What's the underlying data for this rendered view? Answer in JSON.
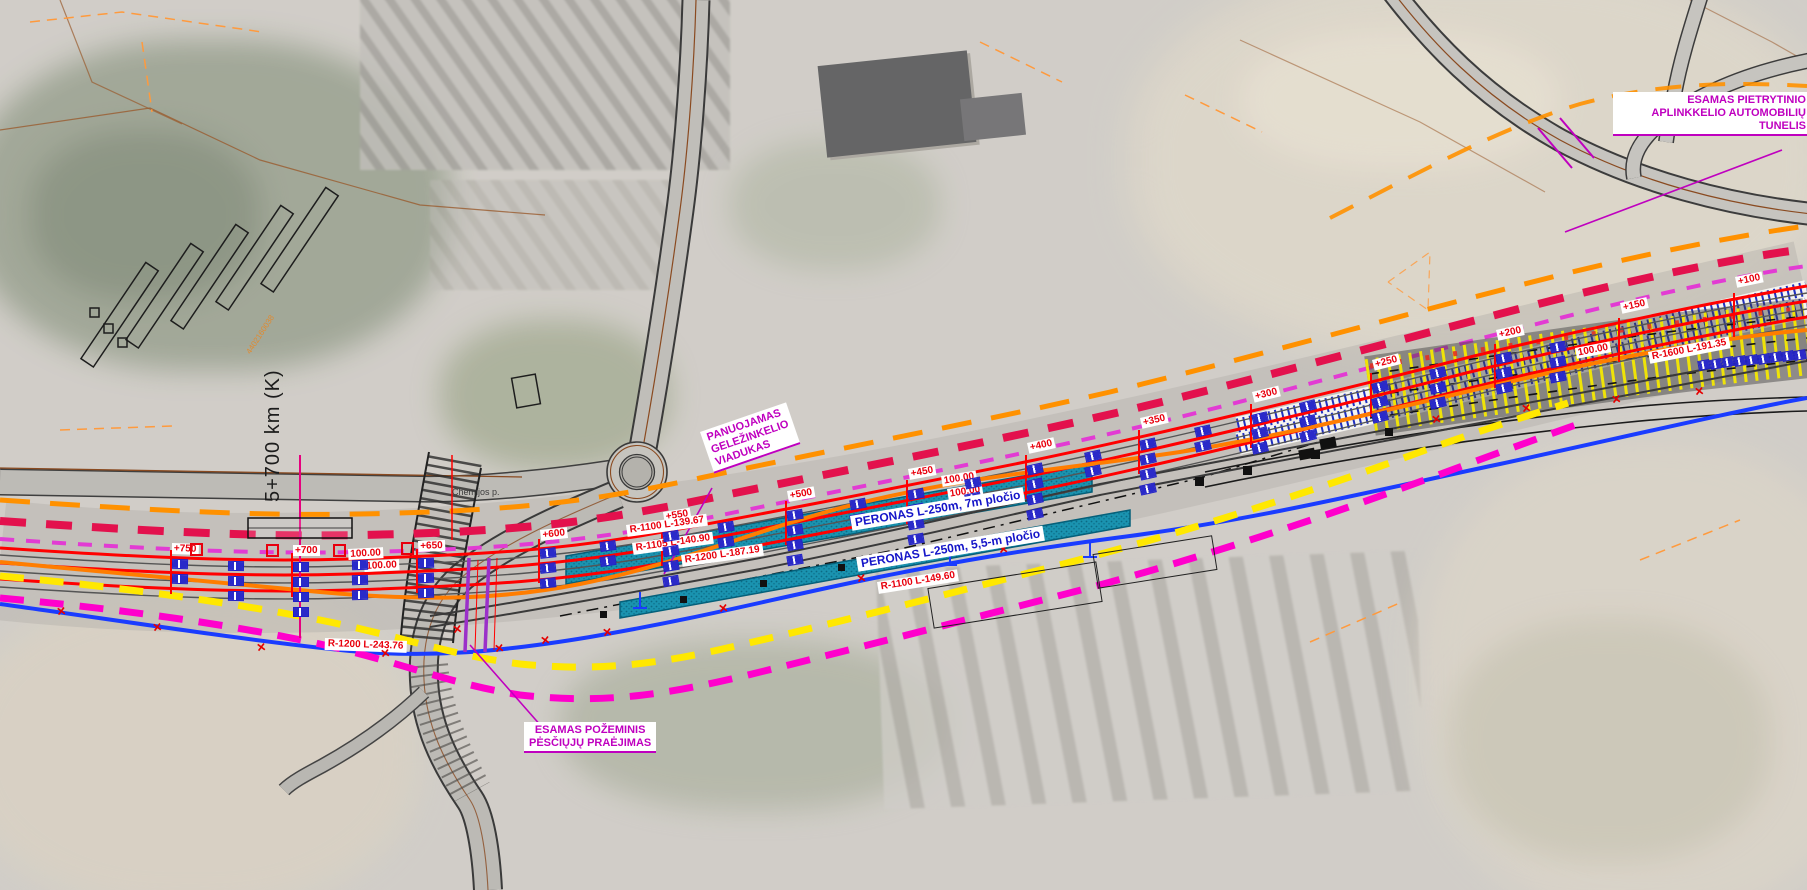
{
  "annotations": {
    "tunnel": [
      "ESAMAS PIETRYTINIO",
      "APLINKKELIO AUTOMOBILIŲ",
      "TUNELIS"
    ],
    "viaduct": [
      "PANUOJAMAS",
      "GELEŽINKELIO",
      "VIADUKAS"
    ],
    "underpass": [
      "ESAMAS POŽEMINIS",
      "PĖSČIŲJŲ PRAĖJIMAS"
    ]
  },
  "km_post": "5+700 km (K)",
  "street_name": "Chemijos p.",
  "parcel_number": "4402160038",
  "platforms": [
    {
      "label": "PERONAS L-250m, 7m pločio",
      "x": 850,
      "y": 516,
      "rot": -9.5
    },
    {
      "label": "PERONAS L-250m, 5,5-m pločio",
      "x": 856,
      "y": 557,
      "rot": -9.5
    }
  ],
  "radius_labels": [
    {
      "text": "R-1100 L-139.67",
      "x": 626,
      "y": 525,
      "rot": -8,
      "color": "#e8000d"
    },
    {
      "text": "R-1105 L-140.90",
      "x": 632,
      "y": 543,
      "rot": -8,
      "color": "#e8000d"
    },
    {
      "text": "R-1200 L-187.19",
      "x": 681,
      "y": 555,
      "rot": -8,
      "color": "#e8000d"
    },
    {
      "text": "R-1100 L-149.60",
      "x": 877,
      "y": 582,
      "rot": -9,
      "color": "#e8000d"
    },
    {
      "text": "R-1200 L-243.76",
      "x": 325,
      "y": 638,
      "rot": 2,
      "color": "#e8000d"
    },
    {
      "text": "R-1600 L-191.35",
      "x": 1648,
      "y": 352,
      "rot": -11,
      "color": "#e8000d"
    }
  ],
  "chainage": [
    {
      "value": "+750",
      "x": 172
    },
    {
      "value": "+700",
      "x": 293
    },
    {
      "value": "+650",
      "x": 418
    },
    {
      "value": "+600",
      "x": 540
    },
    {
      "value": "+550",
      "x": 663
    },
    {
      "value": "+500",
      "x": 787
    },
    {
      "value": "+450",
      "x": 908
    },
    {
      "value": "+400",
      "x": 1027
    },
    {
      "value": "+350",
      "x": 1140
    },
    {
      "value": "+300",
      "x": 1252
    },
    {
      "value": "+250",
      "x": 1372
    },
    {
      "value": "+200",
      "x": 1496
    },
    {
      "value": "+150",
      "x": 1620
    },
    {
      "value": "+100",
      "x": 1735
    }
  ],
  "measurements": [
    {
      "text": "100.00",
      "x": 348,
      "y": 549,
      "rot": -3
    },
    {
      "text": "100.00",
      "x": 364,
      "y": 561,
      "rot": -3
    },
    {
      "text": "100.00",
      "x": 941,
      "y": 476,
      "rot": -9
    },
    {
      "text": "100.00",
      "x": 947,
      "y": 489,
      "rot": -9
    },
    {
      "text": "50.00",
      "x": 979,
      "y": 498,
      "rot": -9
    },
    {
      "text": "100.00",
      "x": 1575,
      "y": 348,
      "rot": -11
    }
  ],
  "tick_clusters": [
    {
      "x": 172,
      "rows": 2
    },
    {
      "x": 228,
      "rows": 3
    },
    {
      "x": 293,
      "rows": 4
    },
    {
      "x": 352,
      "rows": 3
    },
    {
      "x": 418,
      "rows": 3
    },
    {
      "x": 540,
      "rows": 3
    },
    {
      "x": 600,
      "rows": 2
    },
    {
      "x": 663,
      "rows": 4
    },
    {
      "x": 718,
      "rows": 2
    },
    {
      "x": 787,
      "rows": 4
    },
    {
      "x": 850,
      "rows": 2
    },
    {
      "x": 908,
      "rows": 4
    },
    {
      "x": 965,
      "rows": 2
    },
    {
      "x": 1027,
      "rows": 4
    },
    {
      "x": 1085,
      "rows": 2
    },
    {
      "x": 1140,
      "rows": 4
    },
    {
      "x": 1195,
      "rows": 2
    },
    {
      "x": 1252,
      "rows": 3
    },
    {
      "x": 1300,
      "rows": 3
    },
    {
      "x": 1372,
      "rows": 3
    },
    {
      "x": 1430,
      "rows": 3
    },
    {
      "x": 1496,
      "rows": 3
    },
    {
      "x": 1550,
      "rows": 3
    }
  ],
  "x_marks": [
    [
      62,
      612
    ],
    [
      158,
      628
    ],
    [
      262,
      648
    ],
    [
      386,
      654
    ],
    [
      500,
      649
    ],
    [
      608,
      633
    ],
    [
      724,
      609
    ],
    [
      862,
      579
    ],
    [
      1004,
      550
    ],
    [
      458,
      630
    ],
    [
      546,
      641
    ],
    [
      1437,
      420
    ],
    [
      1527,
      409
    ],
    [
      1617,
      400
    ],
    [
      1700,
      392
    ]
  ],
  "boundary_squares": [
    [
      600,
      611,
      7
    ],
    [
      680,
      596,
      7
    ],
    [
      760,
      580,
      7
    ],
    [
      838,
      564,
      7
    ],
    [
      903,
      551,
      7
    ],
    [
      1195,
      477,
      9
    ],
    [
      1243,
      466,
      9
    ],
    [
      1311,
      450,
      9
    ],
    [
      1385,
      428,
      8
    ]
  ],
  "red_hollow_squares": [
    190,
    266,
    333,
    401
  ],
  "blue_t_marks": [
    [
      640,
      600
    ],
    [
      950,
      557
    ],
    [
      1090,
      549
    ]
  ],
  "blue_box_row": {
    "x": 1698,
    "y": 360,
    "count": 9,
    "step": 12,
    "drop": -1.3
  },
  "cars": [
    [
      28,
      477
    ],
    [
      66,
      489
    ],
    [
      118,
      478
    ],
    [
      178,
      489
    ],
    [
      258,
      480
    ],
    [
      328,
      490
    ],
    [
      392,
      480
    ],
    [
      500,
      483
    ]
  ],
  "colors": {
    "annotation_magenta": "#bf00bf",
    "label_red": "#e8000d",
    "label_blue": "#1515c8",
    "track_red": "#ff0000",
    "orange_dashed": "#ff9100",
    "orange_solid": "#ff7d00",
    "crimson_dashed": "#e3114d",
    "violet_dashed": "#e23bd3",
    "yellow_dashed": "#ffe800",
    "magenta_dashed": "#ff00cc",
    "blue_line": "#1a3cff",
    "platform_teal": "#1a93b0",
    "hatch_yellow": "#f4e800"
  }
}
